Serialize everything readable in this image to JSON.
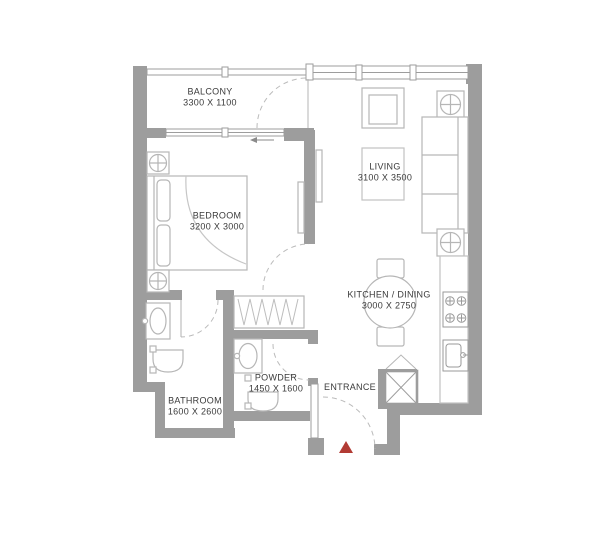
{
  "plan": {
    "rooms": {
      "balcony": {
        "name": "BALCONY",
        "dims": "3300 X 1100"
      },
      "living": {
        "name": "LIVING",
        "dims": "3100 X 3500"
      },
      "bedroom": {
        "name": "BEDROOM",
        "dims": "3200 X 3000"
      },
      "kitchen_dining": {
        "name": "KITCHEN / DINING",
        "dims": "3000 X 2750"
      },
      "bathroom": {
        "name": "BATHROOM",
        "dims": "1600 X 2600"
      },
      "powder": {
        "name": "POWDER",
        "dims": "1450 X 1600"
      },
      "entrance": {
        "name": "ENTRANCE"
      }
    },
    "colors": {
      "wall": "#9d9d9d",
      "furniture_line": "#b6b6b6",
      "label_text": "#3a3a3a",
      "entrance_marker": "#b23b34"
    }
  }
}
